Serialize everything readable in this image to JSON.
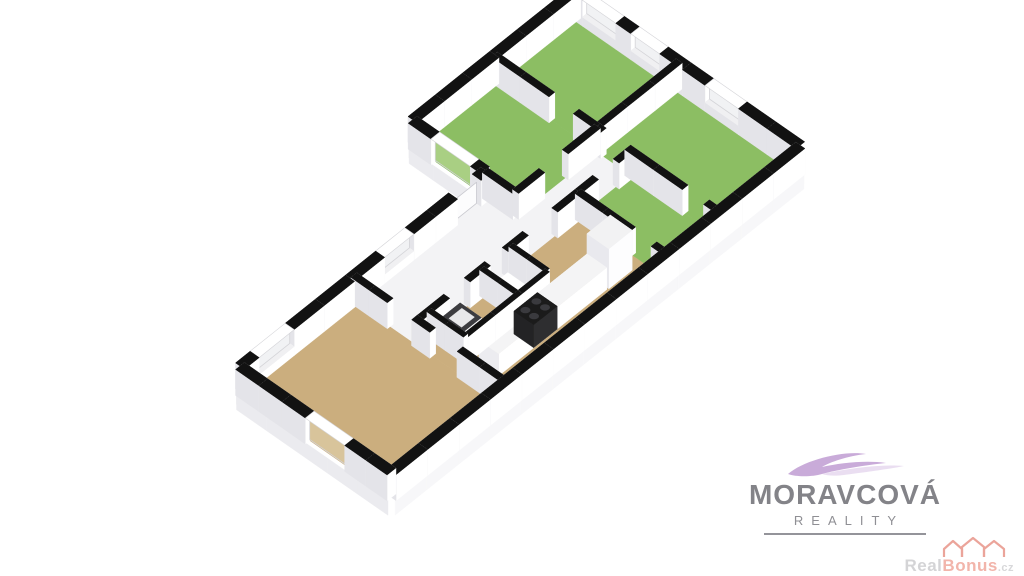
{
  "branding": {
    "name": "MORAVCOVÁ",
    "subtitle": "REALITY",
    "name_color": "#838388",
    "subtitle_color": "#8f8f94",
    "swoosh_color": "#c9abd9",
    "swoosh_color_light": "#dcc8e8"
  },
  "watermark": {
    "text_primary": "Real",
    "text_secondary": "Bonus",
    "text_suffix": ".cz",
    "primary_color": "#d4d4d6",
    "secondary_color": "#f2b5ab",
    "icon": "houses-icon",
    "icon_color": "#eba49a"
  },
  "floorplan": {
    "type": "3d-axonometric-floor-plan",
    "projection": {
      "origin": [
        167.3,
        341.4
      ],
      "ax": [
        29.2,
        -23.3
      ],
      "ay": [
        30.3,
        21.1
      ],
      "wall_height_px": 26,
      "slab_depth_px": 15,
      "chunk_len": 1.1
    },
    "colors": {
      "cap": "#121212",
      "cap_gap": "#ffffff",
      "cap_gap_edge": "#d4d4d8",
      "face_se": "#ffffff",
      "face_sw": "#e4e4e9",
      "face_ne": "#f6f6f8",
      "face_nw": "#ededf0",
      "slab_se": "#f7f7f9",
      "slab_sw": "#ebebef",
      "floor_green": "#8cbe63",
      "floor_tan": "#cbae7e",
      "floor_white": "#f3f3f5",
      "glass_plain": "#f1f2f4",
      "glass_green": "#a9cf83",
      "glass_tan": "#d8c49b",
      "door_leaf": "#fcfcfd",
      "door_leaf_edge": "#c9c9cf",
      "breast_cap": "#f0f0f2"
    },
    "outline": [
      [
        8.4,
        0
      ],
      [
        14,
        0
      ],
      [
        14,
        7.4
      ],
      [
        0,
        7.4
      ],
      [
        0,
        2.4
      ],
      [
        8.4,
        2.4
      ]
    ],
    "rooms": [
      {
        "name": "living-room",
        "floor": "floor_tan",
        "poly": [
          [
            0,
            2.4
          ],
          [
            3.9,
            2.4
          ],
          [
            3.9,
            7.4
          ],
          [
            0,
            7.4
          ]
        ]
      },
      {
        "name": "kitchen",
        "floor": "floor_tan",
        "poly": [
          [
            3.9,
            4.5
          ],
          [
            9.4,
            4.5
          ],
          [
            9.4,
            7.4
          ],
          [
            3.9,
            7.4
          ]
        ]
      },
      {
        "name": "bathroom",
        "floor": "floor_tan",
        "poly": [
          [
            4.3,
            4.5
          ],
          [
            6.1,
            4.5
          ],
          [
            6.1,
            5.7
          ],
          [
            4.3,
            5.7
          ]
        ]
      },
      {
        "name": "wc",
        "floor": "floor_white",
        "poly": [
          [
            6.1,
            4.5
          ],
          [
            7.1,
            4.5
          ],
          [
            7.1,
            5.7
          ],
          [
            6.1,
            5.7
          ]
        ]
      },
      {
        "name": "hallway",
        "floor": "floor_white",
        "poly": [
          [
            3.9,
            2.4
          ],
          [
            8.4,
            2.4
          ],
          [
            8.4,
            3.4
          ],
          [
            11.2,
            3.4
          ],
          [
            11.2,
            4.5
          ],
          [
            3.9,
            4.5
          ]
        ]
      },
      {
        "name": "bedroom-1",
        "floor": "floor_green",
        "poly": [
          [
            8.4,
            0
          ],
          [
            11.2,
            0
          ],
          [
            11.2,
            3.4
          ],
          [
            8.4,
            3.4
          ]
        ]
      },
      {
        "name": "bedroom-2",
        "floor": "floor_green",
        "poly": [
          [
            11.2,
            0
          ],
          [
            14,
            0
          ],
          [
            14,
            3.4
          ],
          [
            11.2,
            3.4
          ]
        ]
      },
      {
        "name": "bedroom-3",
        "floor": "floor_green",
        "poly": [
          [
            11.2,
            3.4
          ],
          [
            14,
            3.4
          ],
          [
            14,
            7.4
          ],
          [
            11.2,
            7.4
          ]
        ]
      },
      {
        "name": "bedroom-4",
        "floor": "floor_green",
        "poly": [
          [
            9.4,
            4.5
          ],
          [
            11.2,
            4.5
          ],
          [
            11.2,
            7.4
          ],
          [
            9.4,
            7.4
          ]
        ]
      }
    ],
    "walls": [
      {
        "name": "ext-nw-upper",
        "a": [
          8.4,
          0
        ],
        "b": [
          14,
          0
        ],
        "t": 0.3,
        "openings": []
      },
      {
        "name": "ext-ne-end",
        "a": [
          14,
          0
        ],
        "b": [
          14,
          7.4
        ],
        "t": 0.3,
        "openings": [
          [
            0.35,
            1.45,
            "win"
          ],
          [
            1.95,
            2.9,
            "win"
          ],
          [
            4.4,
            5.5,
            "win"
          ]
        ]
      },
      {
        "name": "ext-se-long",
        "a": [
          0,
          7.4
        ],
        "b": [
          14,
          7.4
        ],
        "t": 0.3,
        "openings": []
      },
      {
        "name": "ext-sw-end",
        "a": [
          0,
          2.4
        ],
        "b": [
          0,
          7.4
        ],
        "t": 0.3,
        "openings": [
          [
            2.3,
            3.6,
            "win_tall"
          ]
        ]
      },
      {
        "name": "ext-nw-lower",
        "a": [
          0,
          2.4
        ],
        "b": [
          8.4,
          2.4
        ],
        "t": 0.3,
        "openings": [
          [
            0.5,
            1.7,
            "win"
          ],
          [
            4.8,
            5.8,
            "win"
          ],
          [
            7.3,
            8.1,
            "door_leaf"
          ]
        ]
      },
      {
        "name": "ext-w-step",
        "a": [
          8.4,
          0
        ],
        "b": [
          8.4,
          2.4
        ],
        "t": 0.3,
        "openings": [
          [
            0.75,
            2.05,
            "win_green"
          ]
        ]
      },
      {
        "name": "div-bed1-bed2",
        "a": [
          11.2,
          0
        ],
        "b": [
          11.2,
          3.4
        ],
        "t": 0.2,
        "openings": [
          [
            1.9,
            2.7,
            "door"
          ]
        ]
      },
      {
        "name": "div-bed1-hall",
        "a": [
          8.4,
          3.4
        ],
        "b": [
          11.2,
          3.4
        ],
        "t": 0.2,
        "openings": [
          [
            0.9,
            1.7,
            "door"
          ]
        ]
      },
      {
        "name": "div-bed2-bed3",
        "a": [
          11.2,
          3.4
        ],
        "b": [
          14,
          3.4
        ],
        "t": 0.2,
        "openings": []
      },
      {
        "name": "div-bed3-west",
        "a": [
          11.2,
          3.4
        ],
        "b": [
          11.2,
          7.4
        ],
        "t": 0.2,
        "openings": [
          [
            0.2,
            1.0,
            "door"
          ],
          [
            2.9,
            3.6,
            "door"
          ]
        ]
      },
      {
        "name": "div-bed4-hall",
        "a": [
          9.4,
          4.5
        ],
        "b": [
          11.2,
          4.5
        ],
        "t": 0.2,
        "openings": [
          [
            0.6,
            1.3,
            "door"
          ]
        ]
      },
      {
        "name": "div-bed4-west",
        "a": [
          9.4,
          4.5
        ],
        "b": [
          9.4,
          7.4
        ],
        "t": 0.2,
        "openings": [
          [
            1.8,
            2.5,
            "door"
          ]
        ]
      },
      {
        "name": "div-hall-south",
        "a": [
          3.9,
          4.5
        ],
        "b": [
          9.4,
          4.5
        ],
        "t": 0.2,
        "openings": [
          [
            1.0,
            1.7,
            "door"
          ],
          [
            2.4,
            3.0,
            "door"
          ],
          [
            3.7,
            4.7,
            "door"
          ]
        ]
      },
      {
        "name": "div-living-east",
        "a": [
          3.9,
          2.4
        ],
        "b": [
          3.9,
          7.4
        ],
        "t": 0.2,
        "openings": [
          [
            1.2,
            2.0,
            "door"
          ],
          [
            2.6,
            3.5,
            "door"
          ]
        ]
      },
      {
        "name": "div-bath-wc",
        "a": [
          6.1,
          4.5
        ],
        "b": [
          6.1,
          5.7
        ],
        "t": 0.15,
        "openings": []
      },
      {
        "name": "div-bath-west",
        "a": [
          4.3,
          4.5
        ],
        "b": [
          4.3,
          5.7
        ],
        "t": 0.15,
        "openings": []
      },
      {
        "name": "div-bath-south",
        "a": [
          4.3,
          5.7
        ],
        "b": [
          7.1,
          5.7
        ],
        "t": 0.15,
        "openings": []
      },
      {
        "name": "div-wc-east",
        "a": [
          7.1,
          4.5
        ],
        "b": [
          7.1,
          5.7
        ],
        "t": 0.15,
        "openings": []
      },
      {
        "name": "int-step",
        "a": [
          8.4,
          2.4
        ],
        "b": [
          8.4,
          3.4
        ],
        "t": 0.2,
        "openings": []
      }
    ],
    "furniture": [
      {
        "name": "kitchen-counter",
        "rect": [
          4.5,
          5.95,
          8.2,
          6.6
        ],
        "h": 22,
        "top": "#f4f4f5",
        "side": "#ffffff",
        "side2": "#ececf0"
      },
      {
        "name": "stove",
        "rect": [
          5.7,
          5.95,
          6.5,
          6.6
        ],
        "h": 23,
        "top": "#1b1b1b",
        "side": "#2e2e30",
        "side2": "#232325",
        "burners": true
      },
      {
        "name": "fridge",
        "rect": [
          8.25,
          5.9,
          9.05,
          6.62
        ],
        "h": 40,
        "top": "#f2f2f3",
        "side": "#fdfdfe",
        "side2": "#e9e9ee"
      },
      {
        "name": "washing-machine",
        "rect": [
          4.45,
          4.75,
          5.1,
          5.45
        ],
        "h": 20,
        "top": "#3c3c40",
        "side": "#fbfbfc",
        "side2": "#e8e8ec",
        "inset": [
          4.56,
          4.9,
          5.0,
          5.32,
          "#e8e8ea"
        ]
      },
      {
        "name": "toilet",
        "rect": [
          6.3,
          4.7,
          6.78,
          5.28
        ],
        "h": 10,
        "top": "#ffffff",
        "side": "#eceff1",
        "side2": "#e2e5e8"
      }
    ]
  }
}
